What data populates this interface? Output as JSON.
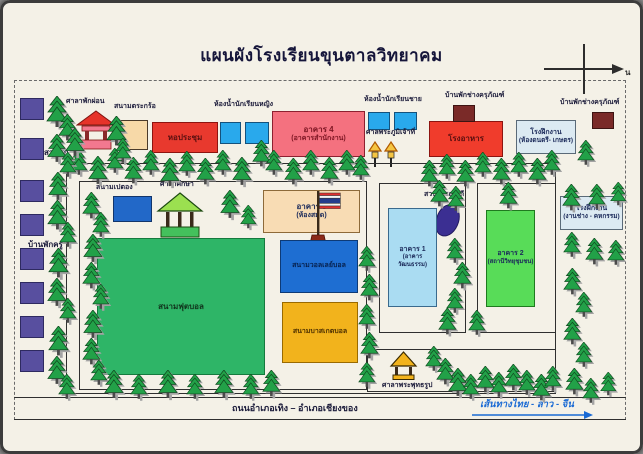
{
  "title": "แผนผังโรงเรียนขุนตาลวิทยาคม",
  "compass": {
    "north_symbol": "น"
  },
  "top_row": {
    "rest_pavilion": "ศาลาพักผ่อน",
    "takraw_court": "สนามตระกร้อ",
    "auditorium": "หอประชุม",
    "girls_restroom": "ห้องน้ำนักเรียนหญิง",
    "building4_line1": "อาคาร 4",
    "building4_line2": "(อาคารสำนักงาน)",
    "boys_restroom": "ห้องน้ำนักเรียนชาย",
    "spirit_house": "ศาลพระภูมิเจ้าที่",
    "cafeteria": "โรงอาหาร",
    "equip_house1": "บ้านพักช่างครุภัณฑ์",
    "workshop1_line1": "โรงฝึกงาน",
    "workshop1_line2": "(ห้องดนตรี- เกษตร)",
    "equip_house2": "บ้านพักช่างครุภัณฑ์"
  },
  "left_column": {
    "teak_garden": "สวนสัก",
    "teacher_housing": "บ้านพักครู",
    "squares_y": [
      98,
      138,
      180,
      214,
      248,
      282,
      316,
      350
    ]
  },
  "campus": {
    "petanque": "สนามเปตอง",
    "study_pavilion": "ศาลาศึกษา",
    "football_field": "สนามฟุตบอล",
    "building3_line1": "อาคาร 3",
    "building3_line2": "(ห้องสมุด)",
    "volleyball": "สนามวอลเลย์บอล",
    "basketball": "สนามบาสเกตบอล",
    "literature_garden": "สวนวรรณคดี",
    "building1_line1": "อาคาร 1",
    "building1_line2": "(อาคารวัฒนธรรม)",
    "building2_line1": "อาคาร 2",
    "building2_line2": "(สถานีวิทยุชุมชน)",
    "workshop2_line1": "โรงฝึกงาน",
    "workshop2_line2": "(งานช่าง - คหกรรม)",
    "buddha_pavilion": "ศาลาพระพุทธรูป"
  },
  "road": {
    "name": "ถนนอำเภอเทิง – อำเภอเชียงของ",
    "route": "เส้นทางไทย - ลาว - จีน"
  },
  "colors": {
    "auditorium_red": "#e8392e",
    "building4_pink": "#f4717f",
    "restroom_blue": "#29a9ec",
    "cafeteria_red": "#f03c2c",
    "equip_maroon": "#7a2a28",
    "workshop_gray": "#dceaf2",
    "teak_purple": "#584f9f",
    "petanque_blue": "#2268c8",
    "field_green": "#2eb567",
    "building3_tan": "#f8dcb4",
    "volleyball_blue": "#1e6ed2",
    "basketball_yellow": "#f2b31c",
    "building1_blue": "#aadcf2",
    "building2_green": "#58dc58",
    "blob_indigo": "#3b2f92",
    "route_blue": "#1a6ad4",
    "takraw_tan": "#f7d9a8"
  },
  "decor": {
    "trees": [
      [
        70,
        150,
        0.8
      ],
      [
        88,
        156,
        0.9
      ],
      [
        106,
        148,
        0.8
      ],
      [
        124,
        157,
        0.85
      ],
      [
        142,
        150,
        0.8
      ],
      [
        160,
        158,
        0.9
      ],
      [
        178,
        151,
        0.8
      ],
      [
        196,
        158,
        0.85
      ],
      [
        214,
        150,
        0.8
      ],
      [
        232,
        157,
        0.9
      ],
      [
        252,
        140,
        0.85
      ],
      [
        265,
        150,
        0.8
      ],
      [
        284,
        158,
        0.85
      ],
      [
        302,
        150,
        0.8
      ],
      [
        320,
        157,
        0.85
      ],
      [
        338,
        150,
        0.8
      ],
      [
        352,
        155,
        0.8
      ],
      [
        420,
        160,
        0.85
      ],
      [
        438,
        154,
        0.8
      ],
      [
        456,
        160,
        0.85
      ],
      [
        474,
        152,
        0.8
      ],
      [
        492,
        158,
        0.85
      ],
      [
        510,
        152,
        0.8
      ],
      [
        528,
        158,
        0.85
      ],
      [
        543,
        150,
        0.8
      ],
      [
        577,
        140,
        0.8
      ],
      [
        46,
        96,
        1
      ],
      [
        58,
        114,
        0.85
      ],
      [
        47,
        134,
        0.9
      ],
      [
        59,
        152,
        0.8
      ],
      [
        48,
        172,
        0.9
      ],
      [
        47,
        200,
        0.95
      ],
      [
        59,
        222,
        0.8
      ],
      [
        48,
        248,
        0.95
      ],
      [
        47,
        278,
        0.9
      ],
      [
        59,
        298,
        0.8
      ],
      [
        48,
        326,
        0.95
      ],
      [
        47,
        356,
        0.9
      ],
      [
        58,
        374,
        0.8
      ],
      [
        65,
        128,
        0.9
      ],
      [
        106,
        116,
        0.95
      ],
      [
        114,
        138,
        0.8
      ],
      [
        82,
        192,
        0.85
      ],
      [
        92,
        212,
        0.8
      ],
      [
        83,
        234,
        0.9
      ],
      [
        82,
        262,
        0.85
      ],
      [
        92,
        284,
        0.8
      ],
      [
        83,
        310,
        0.9
      ],
      [
        82,
        338,
        0.85
      ],
      [
        90,
        360,
        0.8
      ],
      [
        220,
        190,
        0.9
      ],
      [
        240,
        205,
        0.75
      ],
      [
        104,
        370,
        0.9
      ],
      [
        130,
        374,
        0.8
      ],
      [
        158,
        370,
        0.9
      ],
      [
        186,
        374,
        0.8
      ],
      [
        214,
        370,
        0.9
      ],
      [
        242,
        374,
        0.8
      ],
      [
        262,
        370,
        0.85
      ],
      [
        358,
        246,
        0.8
      ],
      [
        360,
        274,
        0.85
      ],
      [
        358,
        304,
        0.8
      ],
      [
        360,
        332,
        0.85
      ],
      [
        358,
        362,
        0.8
      ],
      [
        430,
        180,
        0.85
      ],
      [
        447,
        186,
        0.8
      ],
      [
        499,
        182,
        0.85
      ],
      [
        446,
        238,
        0.8
      ],
      [
        453,
        262,
        0.85
      ],
      [
        446,
        288,
        0.8
      ],
      [
        438,
        308,
        0.85
      ],
      [
        468,
        310,
        0.8
      ],
      [
        562,
        184,
        0.85
      ],
      [
        588,
        184,
        0.8
      ],
      [
        610,
        182,
        0.75
      ],
      [
        563,
        232,
        0.8
      ],
      [
        585,
        238,
        0.85
      ],
      [
        607,
        240,
        0.8
      ],
      [
        563,
        268,
        0.85
      ],
      [
        575,
        292,
        0.8
      ],
      [
        563,
        318,
        0.85
      ],
      [
        575,
        342,
        0.8
      ],
      [
        565,
        368,
        0.85
      ],
      [
        582,
        378,
        0.8
      ],
      [
        600,
        372,
        0.75
      ],
      [
        425,
        346,
        0.8
      ],
      [
        436,
        358,
        0.85
      ],
      [
        448,
        368,
        0.9
      ],
      [
        462,
        374,
        0.8
      ],
      [
        476,
        366,
        0.85
      ],
      [
        490,
        372,
        0.8
      ],
      [
        504,
        364,
        0.85
      ],
      [
        518,
        370,
        0.8
      ],
      [
        532,
        374,
        0.85
      ],
      [
        544,
        366,
        0.8
      ]
    ]
  }
}
